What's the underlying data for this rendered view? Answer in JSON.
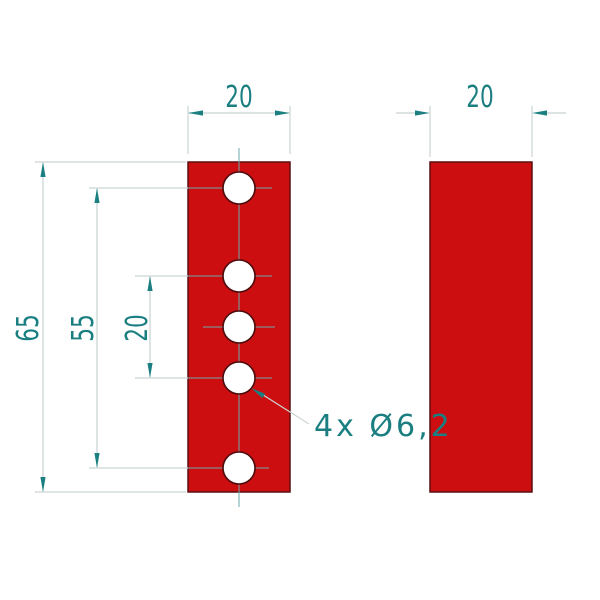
{
  "drawing": {
    "type": "2-view technical drawing of a flat bar with holes",
    "hole_count_front_view": 5
  },
  "labels": {
    "front_width": "20",
    "side_width": "20",
    "overall_height": "65",
    "hole_span": "55",
    "hole_pitch": "20",
    "hole_callout": "4x Ø6,2"
  },
  "colors": {
    "part_red": "#cc0e11",
    "part_outline": "#5a1010",
    "hole_outline": "#4a0c0c",
    "dimension_teal": "#1b7f81",
    "line_light_gray": "#ccd5d3",
    "centerline_teal": "#6ea8aa",
    "background": "#ffffff"
  }
}
